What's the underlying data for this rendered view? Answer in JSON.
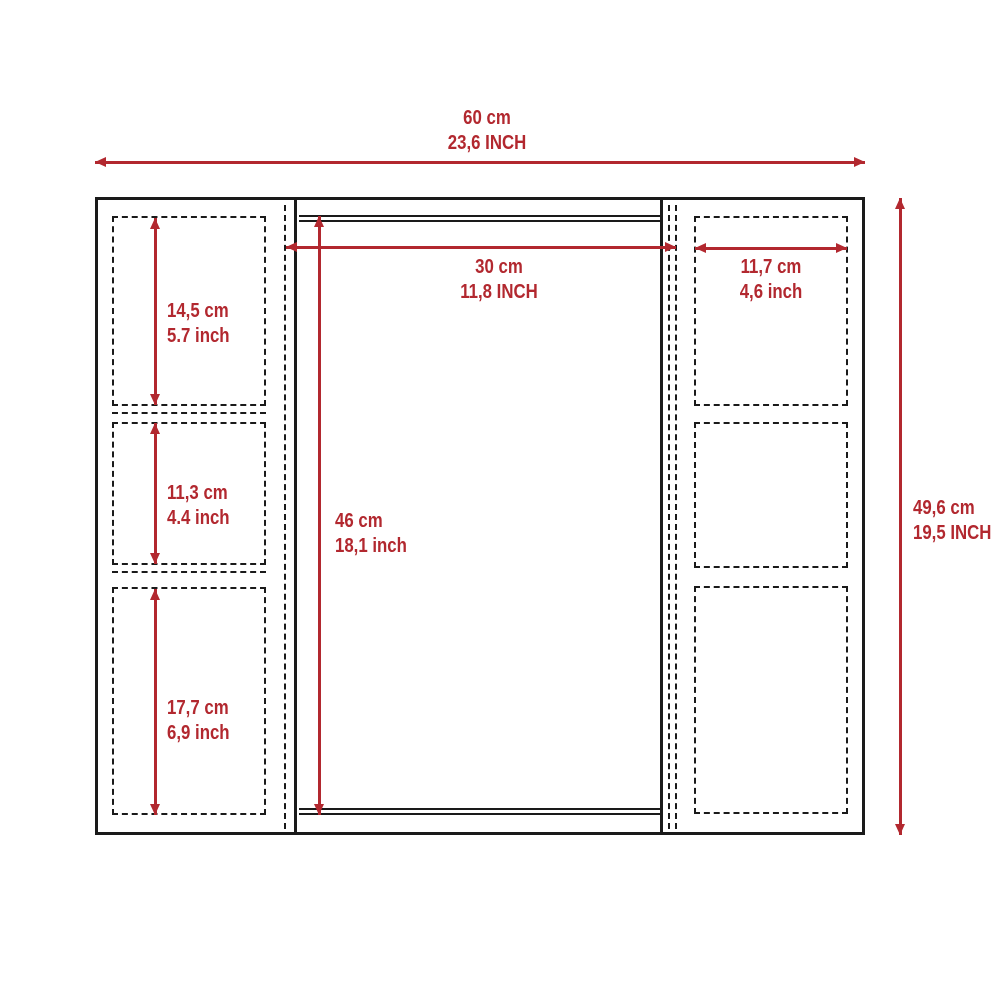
{
  "drawing": {
    "type": "cabinet-dimension-diagram",
    "colors": {
      "dimension_red": "#b2282f",
      "line_black": "#1a1a1a",
      "background": "#ffffff"
    },
    "dims": {
      "overall_width": {
        "cm": "60 cm",
        "inch": "23,6 INCH"
      },
      "overall_height": {
        "cm": "49,6 cm",
        "inch": "19,5 INCH"
      },
      "mirror_width": {
        "cm": "30 cm",
        "inch": "11,8 INCH"
      },
      "right_shelf_width": {
        "cm": "11,7 cm",
        "inch": "4,6 inch"
      },
      "left_shelf_top": {
        "cm": "14,5 cm",
        "inch": "5.7 inch"
      },
      "left_shelf_middle": {
        "cm": "11,3 cm",
        "inch": "4.4 inch"
      },
      "left_shelf_bottom": {
        "cm": "17,7 cm",
        "inch": "6,9 inch"
      },
      "mirror_height": {
        "cm": "46 cm",
        "inch": "18,1 inch"
      }
    }
  }
}
